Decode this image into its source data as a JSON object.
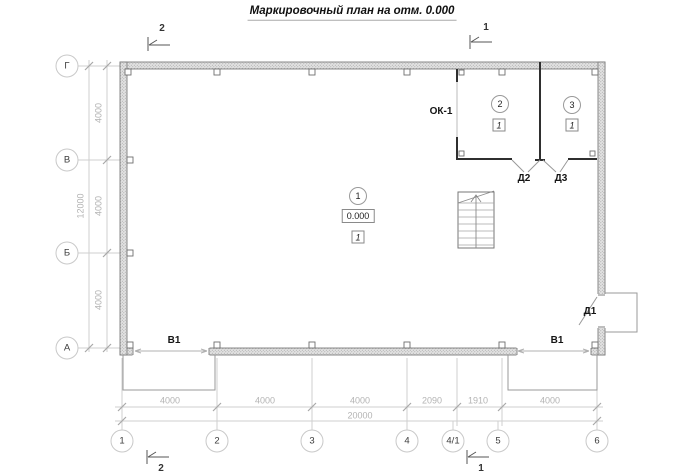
{
  "title": "Маркировочный план на отм. 0.000",
  "section_marks": {
    "top_left": "2",
    "top_right": "1",
    "bottom_left": "2",
    "bottom_right": "1"
  },
  "axis_labels": {
    "v1": "Г",
    "v2": "В",
    "v3": "Б",
    "v4": "А",
    "h1": "1",
    "h2": "2",
    "h3": "3",
    "h4": "4",
    "h5": "4/1",
    "h6": "5",
    "h7": "6"
  },
  "dims": {
    "left_total": "12000",
    "left_seg1": "4000",
    "left_seg2": "4000",
    "left_seg3": "4000",
    "bottom_seg1": "4000",
    "bottom_seg2": "4000",
    "bottom_seg3": "4000",
    "bottom_seg4": "2090",
    "bottom_seg5": "1910",
    "bottom_seg6": "4000",
    "bottom_total": "20000"
  },
  "rooms": {
    "room1_number": "1",
    "room2_number": "2",
    "room3_number": "3",
    "floor_mark": "1",
    "elevation": "0.000"
  },
  "openings": {
    "window": "ОК-1",
    "door1": "Д1",
    "door2": "Д2",
    "door3": "Д3",
    "gate_left": "В1",
    "gate_right": "В1"
  },
  "colors": {
    "wall_fill": "#e2e2e2",
    "wall_line": "#7d7d7d",
    "partition": "#2f2f2f",
    "dim_gray": "#b3b3b3",
    "axis_gray": "#cfcfcf",
    "label_dark": "#141414"
  }
}
